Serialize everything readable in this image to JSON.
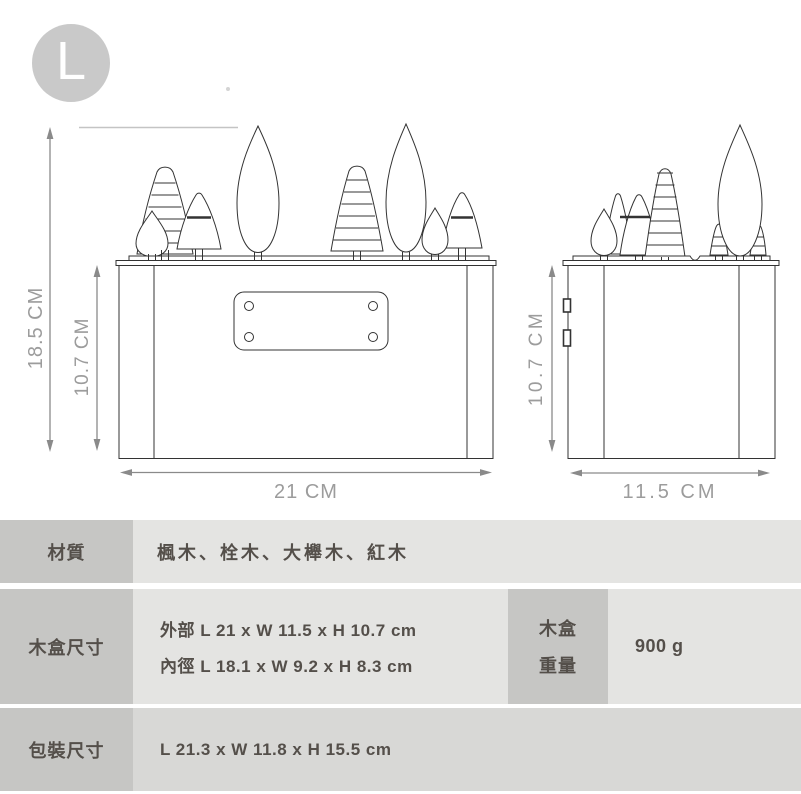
{
  "badge_letter": "L",
  "drawing": {
    "front_total_height": "18.5 CM",
    "front_box_height": "10.7 CM",
    "front_width": "21 CM",
    "side_box_height": "10.7 CM",
    "side_depth": "11.5 CM"
  },
  "spec_table": {
    "material": {
      "label": "材質",
      "value": "楓木、栓木、大櫸木、紅木"
    },
    "box_size": {
      "label": "木盒尺寸",
      "outer": "外部  L 21 x W 11.5 x H 10.7 cm",
      "inner": "內徑  L 18.1 x W 9.2 x H 8.3 cm"
    },
    "box_weight": {
      "label_line1": "木盒",
      "label_line2": "重量",
      "value": "900 g"
    },
    "package_size": {
      "label": "包裝尺寸",
      "value": "L 21.3 x W 11.8 x H 15.5 cm"
    }
  },
  "colors": {
    "badge_bg": "#c9c9c9",
    "label_cell_bg": "#c6c6c4",
    "value_cell_bg": "#e4e4e2",
    "value_cell_bg_alt": "#d8d8d6",
    "dimension_gray": "#9c9c9c",
    "drawing_line": "#333333",
    "table_text": "#544f4a"
  }
}
